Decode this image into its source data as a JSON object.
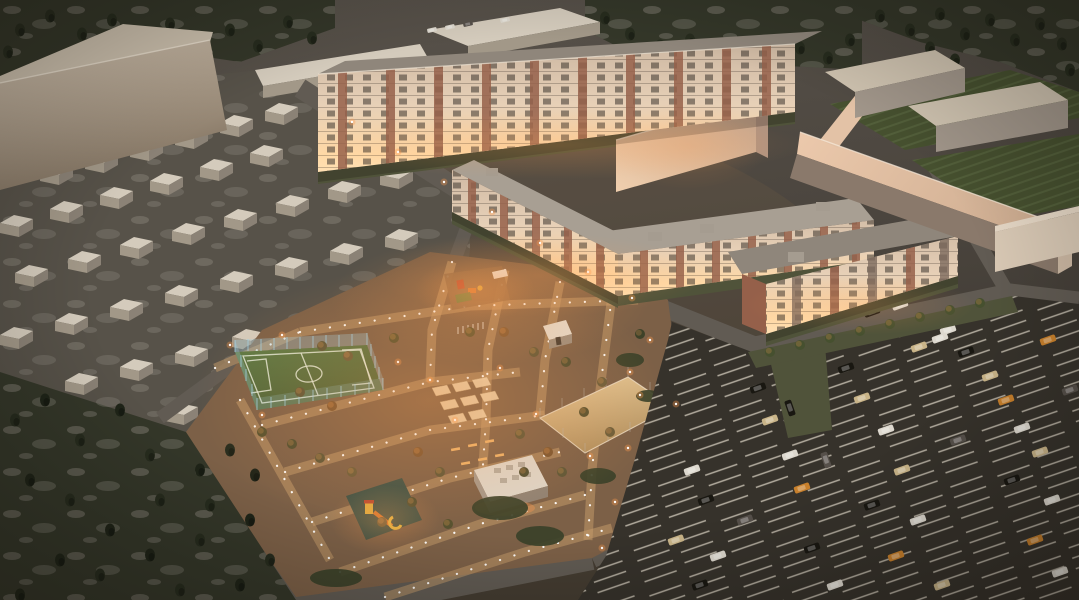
{
  "scene": {
    "type": "aerial-architectural-night-render",
    "description": "dusk aerial 3D visualization of a residential complex",
    "objects": [
      "long-apartment-building",
      "u-shaped-apartment-building",
      "right-apartment-building",
      "industrial-building-top-left",
      "garage-rows",
      "warehouses-top-right",
      "soccer-field",
      "sports-court",
      "playgrounds",
      "pavilion",
      "parking-lot",
      "forest-bottom-left",
      "trees-top",
      "roads",
      "street-lights",
      "cars"
    ]
  },
  "palette": {
    "bg_top": "#5a544c",
    "bg_mid": "#4c463f",
    "bg_bottom": "#3a352e",
    "forest": "#343729",
    "conifer": "#272c1e",
    "conifer2": "#1f2418",
    "mottle": "#8a857a",
    "garage_ground": "#575249",
    "shed_roof": "#d4cbbc",
    "shed_front": "#a29888",
    "shed_side": "#8b8276",
    "road": "#615b53",
    "asphalt": "#36322b",
    "stall": "#d2cabb",
    "court_ground": "#7c6047",
    "path": "#c79e6c",
    "dot": "#ffffff",
    "glow": "#ff9c4c",
    "field": "#5f7b46",
    "field_dark": "#4a6136",
    "fieldline": "#e2ead9",
    "fence": "#9fd0e4",
    "court_tan": "#d9b583",
    "facade_top": "#c7b29d",
    "facade_mid": "#e7d0b7",
    "facade_lit": "#ffd9a6",
    "brick": "#95604a",
    "roof": "#8f867b",
    "roof_light": "#a89f93",
    "win": "#3c342e",
    "warehouse_top": "#cfc3b0",
    "warehouse_front": "#a1968a",
    "wall_pink": "#ecc9ac",
    "wall_face": "#8a796b",
    "tl_face_light": "#dccdb9",
    "tl_face_dark": "#80715f",
    "lawn": "#50533a",
    "hatch": "#46502f",
    "car_white": "#ddd8ce",
    "car_black": "#191711",
    "car_beige": "#c9b488",
    "car_orange": "#c8802c",
    "car_grey": "#56504a",
    "t1_light": "#f0cfae",
    "t1_dark": "#c2a189"
  }
}
